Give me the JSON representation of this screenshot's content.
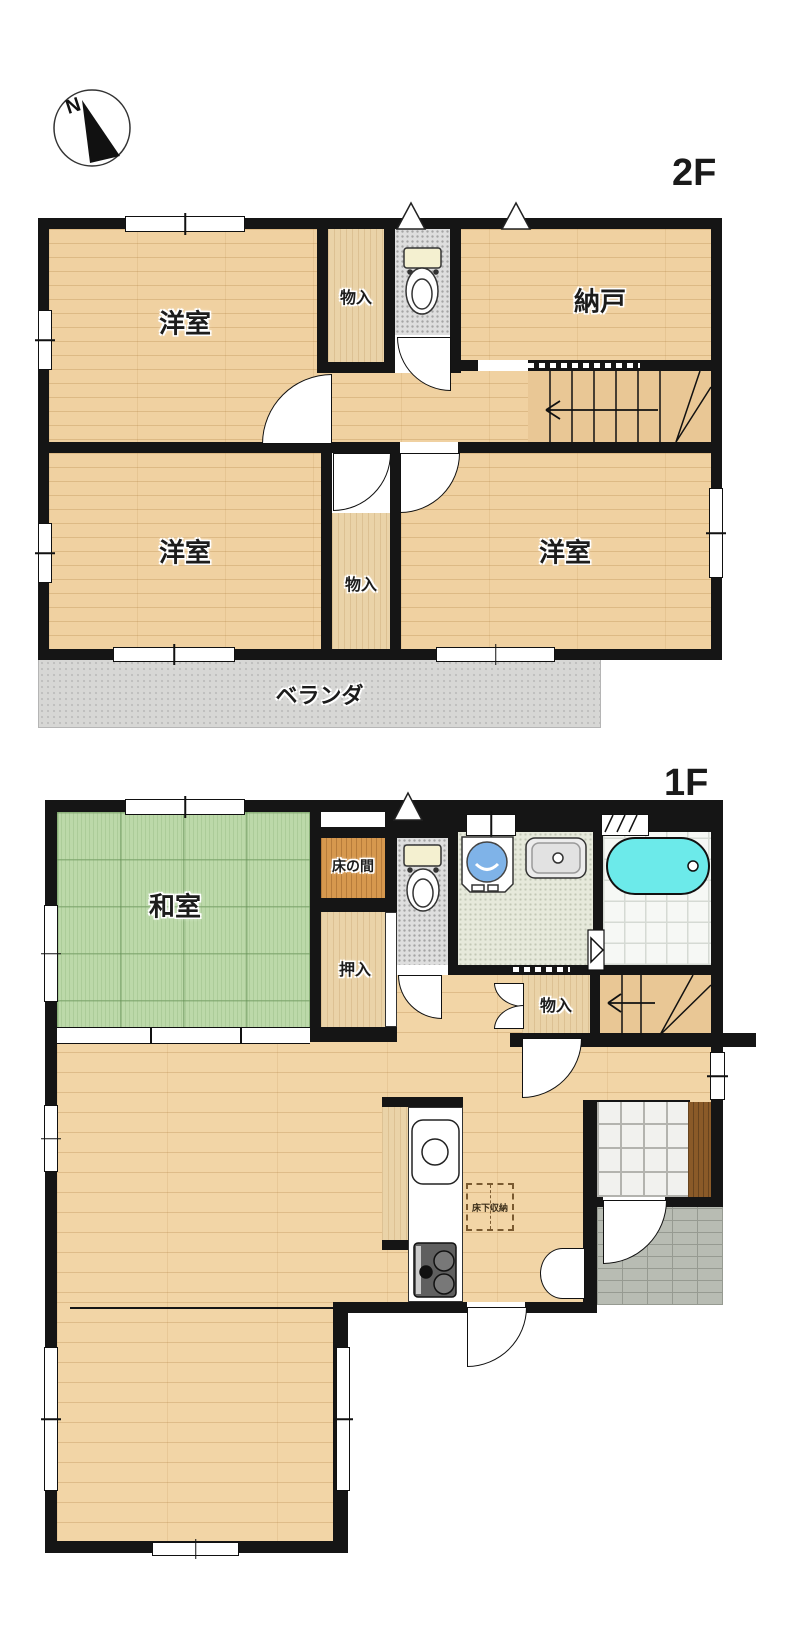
{
  "compass": {
    "north_label": "N"
  },
  "floor2": {
    "title": "2F",
    "room_nw": "洋室",
    "closet_top": "物入",
    "storage_room": "納戸",
    "room_sw": "洋室",
    "closet_bottom": "物入",
    "room_se": "洋室",
    "balcony": "ベランダ"
  },
  "floor1": {
    "title": "1F",
    "washitsu": "和室",
    "tokonoma": "床の間",
    "oshiire": "押入",
    "monoire": "物入",
    "underfloor_storage": "床下収納"
  },
  "colors": {
    "wall_black": "#151515",
    "wood_floor": "#f0d1a1",
    "closet_wood": "#ead3a8",
    "tokonoma_wood": "#d6984e",
    "tatami_green": "#bcd9a9",
    "bathtub_cyan": "#6ceaea",
    "washer_blue": "#7fb3e8",
    "balcony_gray": "#d7d7d5",
    "stair_tan": "#e9c795",
    "shoe_cabinet_brown": "#8a5a28"
  }
}
